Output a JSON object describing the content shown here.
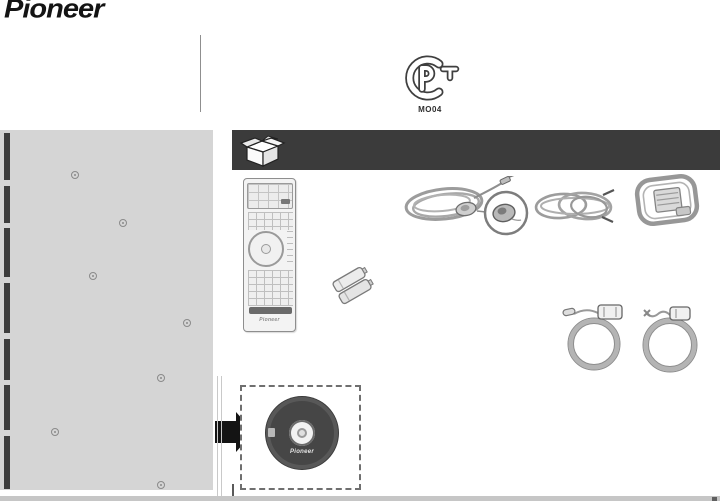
{
  "brand": {
    "logo_text": "Pioneer"
  },
  "certification": {
    "mark": "PCT",
    "code": "MO04"
  },
  "accessories_panel": {
    "header_icon": "open-box-icon",
    "items": [
      {
        "id": "remote-control",
        "brand_label": "Pioneer"
      },
      {
        "id": "control-cable-with-remote-sensor"
      },
      {
        "id": "antenna-wire"
      },
      {
        "id": "am-loop-antenna"
      },
      {
        "id": "aa-batteries"
      },
      {
        "id": "power-cord-left"
      },
      {
        "id": "power-cord-right"
      },
      {
        "id": "cd-rom",
        "brand_label": "Pioneer"
      }
    ]
  },
  "colors": {
    "panel_gray": "#d5d5d5",
    "header_bar": "#3b3b3b",
    "disc_dark": "#464646",
    "arrow_black": "#141414",
    "scan_strip": "#c6c6c6"
  }
}
